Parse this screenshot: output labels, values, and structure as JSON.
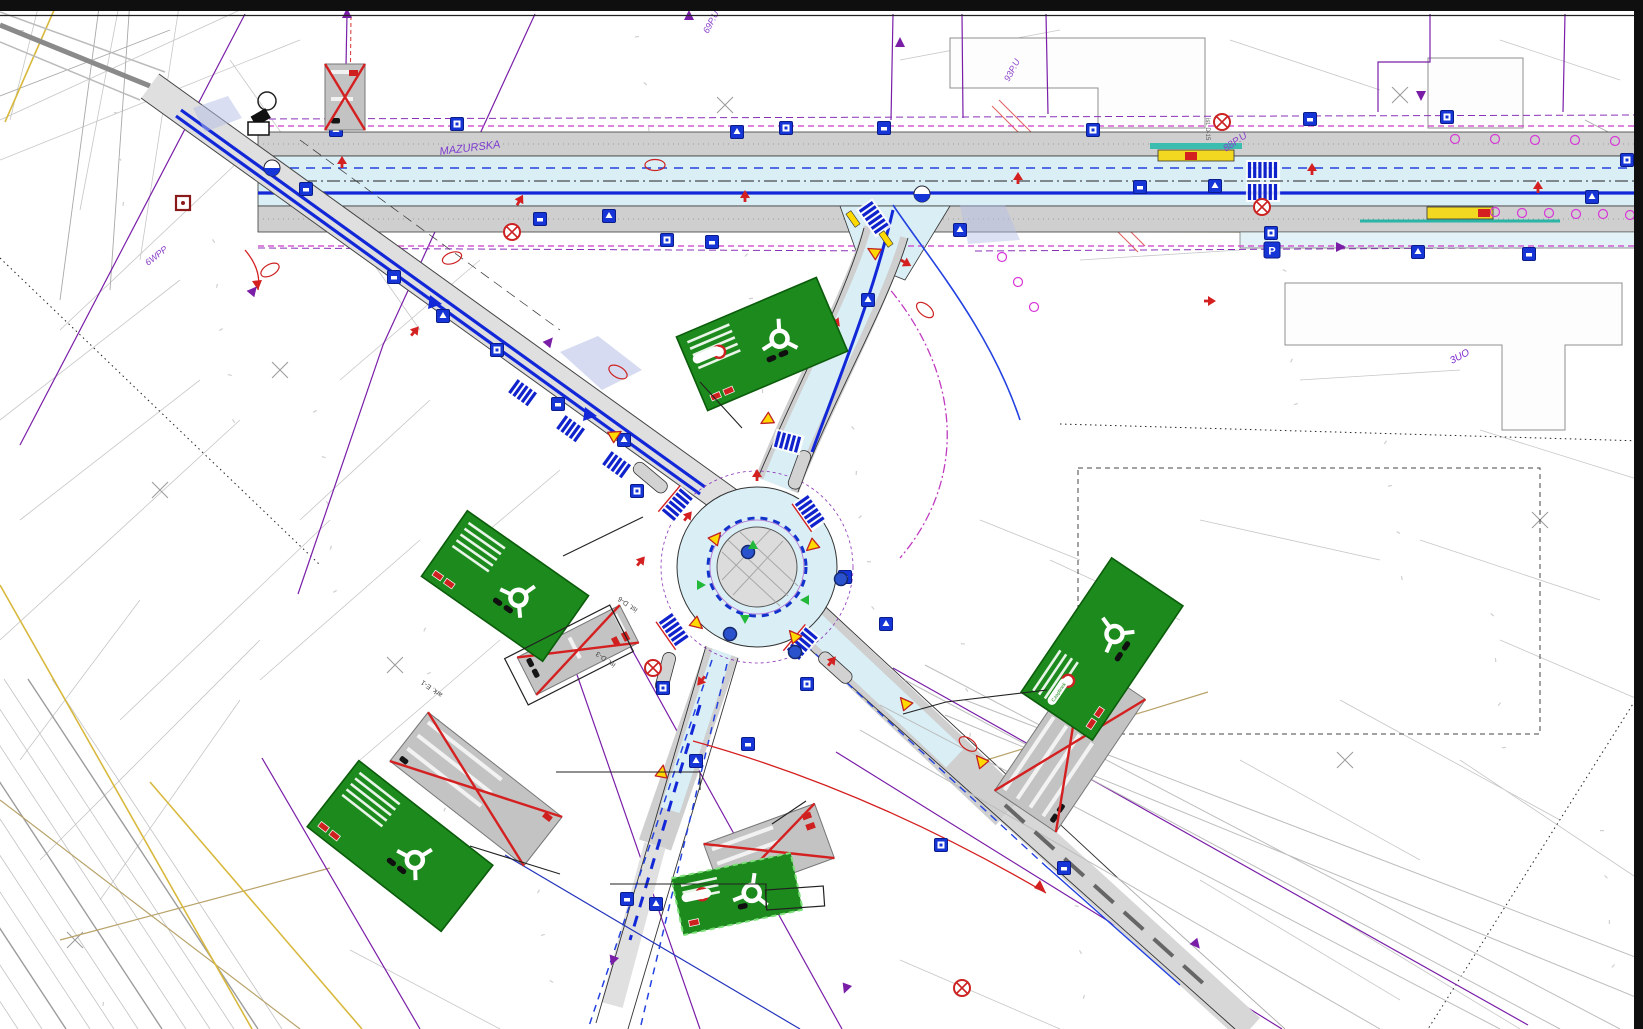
{
  "document": {
    "type": "traffic-organization-engineering-plan",
    "description": "Road design plan of a roundabout intersection with signage overlaid on cadastral map"
  },
  "palette": {
    "carriageway_cyan": "#d9eef5",
    "sidewalk_gray": "#cfcfcf",
    "marking_blue": "#1228d8",
    "secondary_blue": "#2342e0",
    "sign_blue": "#1535d6",
    "boundary_purple": "#7a1ea8",
    "magenta_dash": "#cb3bcb",
    "sign_green": "#1d8a1d",
    "sign_green_border": "#0b5c0b",
    "warning_yellow": "#ffd900",
    "bus_bar_yellow": "#f2d820",
    "teal_line": "#2ab5a5",
    "alert_red": "#d42020",
    "cadastral_gray": "#c6c6c6",
    "tan_line": "#b8a36a",
    "sheet_edge_black": "#0f0f0f"
  },
  "labels": [
    {
      "text": "MAZURSKA",
      "x": 440,
      "y": 155,
      "rot": -7,
      "size": 11,
      "color": "#7d3bd0",
      "italic": true
    },
    {
      "text": "88P.U",
      "x": 1226,
      "y": 152,
      "rot": -35,
      "size": 10,
      "color": "#8a40c8",
      "italic": true
    },
    {
      "text": "69P.U",
      "x": 708,
      "y": 34,
      "rot": -62,
      "size": 9,
      "color": "#8a40c8",
      "italic": true
    },
    {
      "text": "93P.U",
      "x": 1009,
      "y": 82,
      "rot": -62,
      "size": 9,
      "color": "#8a40c8",
      "italic": true
    },
    {
      "text": "6WPP",
      "x": 148,
      "y": 266,
      "rot": -38,
      "size": 9,
      "color": "#8a40c8",
      "italic": true
    },
    {
      "text": "3UO",
      "x": 1452,
      "y": 364,
      "rot": -28,
      "size": 10,
      "color": "#7d26cd",
      "italic": true
    },
    {
      "text": "ist. D-3",
      "x": 616,
      "y": 664,
      "rot": 215,
      "size": 7,
      "color": "#444",
      "italic": false
    },
    {
      "text": "ist. D-6",
      "x": 638,
      "y": 609,
      "rot": 215,
      "size": 7,
      "color": "#444",
      "italic": false
    },
    {
      "text": "ark. E-1",
      "x": 443,
      "y": 694,
      "rot": 215,
      "size": 7,
      "color": "#444",
      "italic": false
    },
    {
      "text": "ist. D-15",
      "x": 1206,
      "y": 118,
      "rot": 90,
      "size": 6,
      "color": "#555",
      "italic": false
    }
  ],
  "signs": {
    "route_pill_text": "Czaplinek",
    "green_direction_signs": [
      {
        "x": 762,
        "y": 344,
        "w": 152,
        "h": 80,
        "rot": -23,
        "dashed": false,
        "ring": true,
        "pill": true,
        "pill_text": "",
        "bars": 5,
        "badges": 2,
        "blobs": 2
      },
      {
        "x": 505,
        "y": 586,
        "w": 148,
        "h": 80,
        "rot": 35,
        "dashed": false,
        "ring": false,
        "pill": false,
        "pill_text": "",
        "bars": 5,
        "badges": 2,
        "blobs": 2
      },
      {
        "x": 400,
        "y": 846,
        "w": 170,
        "h": 84,
        "rot": 38,
        "dashed": false,
        "ring": false,
        "pill": false,
        "pill_text": "",
        "bars": 5,
        "badges": 2,
        "blobs": 2
      },
      {
        "x": 1102,
        "y": 649,
        "w": 162,
        "h": 86,
        "rot": -56,
        "dashed": false,
        "ring": true,
        "pill": true,
        "pill_text": "Czaplinek",
        "bars": 4,
        "badges": 2,
        "blobs": 2
      },
      {
        "x": 737,
        "y": 894,
        "w": 122,
        "h": 58,
        "rot": -12,
        "dashed": true,
        "ring": true,
        "pill": true,
        "pill_text": "",
        "bars": 3,
        "badges": 1,
        "blobs": 1
      }
    ],
    "removed_signs_gray": [
      {
        "x": 345,
        "y": 97,
        "w": 40,
        "h": 66,
        "rot": 0,
        "bars": 2,
        "badges": 1,
        "blobs": 1
      },
      {
        "x": 578,
        "y": 650,
        "w": 42,
        "h": 115,
        "rot": 63,
        "bars": 2,
        "badges": 2,
        "blobs": 2
      },
      {
        "x": 769,
        "y": 851,
        "w": 118,
        "h": 58,
        "rot": -20,
        "bars": 3,
        "badges": 2,
        "blobs": 1
      },
      {
        "x": 1070,
        "y": 745,
        "w": 160,
        "h": 74,
        "rot": -56,
        "bars": 4,
        "badges": 3,
        "blobs": 2
      },
      {
        "x": 476,
        "y": 789,
        "w": 170,
        "h": 62,
        "rot": 38,
        "bars": 3,
        "badges": 1,
        "blobs": 1
      }
    ]
  },
  "roundabout": {
    "cx": 757,
    "cy": 567,
    "outer_r": 80,
    "dashed_r": 49,
    "island_r": 40,
    "purple_r": 96
  },
  "crosswalks": [
    {
      "x": 677,
      "y": 505,
      "rot": 130,
      "n": 6,
      "red": true
    },
    {
      "x": 810,
      "y": 512,
      "rot": 55,
      "n": 6,
      "red": true
    },
    {
      "x": 674,
      "y": 630,
      "rot": 55,
      "n": 6,
      "red": true
    },
    {
      "x": 802,
      "y": 644,
      "rot": 130,
      "n": 6,
      "red": true
    },
    {
      "x": 874,
      "y": 218,
      "rot": 55,
      "n": 6,
      "red": false
    },
    {
      "x": 1263,
      "y": 170,
      "rot": 0,
      "n": 6,
      "red": false
    },
    {
      "x": 1263,
      "y": 192,
      "rot": 0,
      "n": 6,
      "red": false
    },
    {
      "x": 523,
      "y": 393,
      "rot": 36,
      "n": 5,
      "red": false
    },
    {
      "x": 571,
      "y": 429,
      "rot": 36,
      "n": 5,
      "red": false
    },
    {
      "x": 617,
      "y": 465,
      "rot": 36,
      "n": 5,
      "red": false
    },
    {
      "x": 788,
      "y": 442,
      "rot": 15,
      "n": 5,
      "red": false
    }
  ],
  "icons": {
    "blue_squares": [
      [
        306,
        189
      ],
      [
        336,
        130
      ],
      [
        457,
        124
      ],
      [
        540,
        219
      ],
      [
        609,
        216
      ],
      [
        667,
        240
      ],
      [
        712,
        242
      ],
      [
        737,
        132
      ],
      [
        786,
        128
      ],
      [
        884,
        128
      ],
      [
        960,
        230
      ],
      [
        1093,
        130
      ],
      [
        1140,
        187
      ],
      [
        1215,
        186
      ],
      [
        1271,
        233
      ],
      [
        1310,
        119
      ],
      [
        1418,
        252
      ],
      [
        1447,
        117
      ],
      [
        1529,
        254
      ],
      [
        1592,
        197
      ],
      [
        1627,
        160
      ],
      [
        394,
        277
      ],
      [
        443,
        316
      ],
      [
        497,
        350
      ],
      [
        558,
        404
      ],
      [
        624,
        440
      ],
      [
        637,
        491
      ],
      [
        845,
        577
      ],
      [
        886,
        624
      ],
      [
        663,
        688
      ],
      [
        748,
        744
      ],
      [
        696,
        761
      ],
      [
        807,
        684
      ],
      [
        627,
        899
      ],
      [
        656,
        904
      ],
      [
        941,
        845
      ],
      [
        1064,
        868
      ],
      [
        868,
        300
      ]
    ],
    "parking_sign": [
      1272,
      250
    ],
    "yellow_triangles": [
      [
        716,
        538,
        40
      ],
      [
        812,
        546,
        -130
      ],
      [
        697,
        624,
        130
      ],
      [
        794,
        636,
        -40
      ],
      [
        874,
        252,
        -60
      ],
      [
        905,
        703,
        -40
      ],
      [
        615,
        435,
        60
      ],
      [
        767,
        420,
        -120
      ],
      [
        662,
        772,
        10
      ],
      [
        981,
        761,
        -40
      ]
    ],
    "purple_triangles": [
      [
        689,
        16,
        0
      ],
      [
        900,
        43,
        0
      ],
      [
        1340,
        247,
        90
      ],
      [
        1421,
        95,
        180
      ],
      [
        347,
        14,
        0
      ],
      [
        253,
        291,
        40
      ],
      [
        549,
        342,
        40
      ],
      [
        846,
        988,
        200
      ],
      [
        613,
        960,
        200
      ],
      [
        1196,
        944,
        140
      ]
    ],
    "magenta_circles": [
      [
        1495,
        212
      ],
      [
        1522,
        213
      ],
      [
        1549,
        213
      ],
      [
        1576,
        214
      ],
      [
        1603,
        214
      ],
      [
        1630,
        215
      ],
      [
        1455,
        139
      ],
      [
        1495,
        139
      ],
      [
        1535,
        140
      ],
      [
        1575,
        140
      ],
      [
        1615,
        141
      ],
      [
        1002,
        257
      ],
      [
        1018,
        282
      ],
      [
        1034,
        307
      ]
    ],
    "red_markers": [
      [
        342,
        162,
        0
      ],
      [
        520,
        200,
        30
      ],
      [
        745,
        196,
        0
      ],
      [
        1018,
        178,
        0
      ],
      [
        1312,
        169,
        0
      ],
      [
        1538,
        187,
        0
      ],
      [
        906,
        263,
        120
      ],
      [
        836,
        322,
        140
      ],
      [
        688,
        516,
        40
      ],
      [
        641,
        561,
        40
      ],
      [
        701,
        681,
        220
      ],
      [
        832,
        661,
        40
      ],
      [
        560,
        641,
        220
      ],
      [
        415,
        331,
        40
      ],
      [
        1210,
        301,
        90
      ],
      [
        757,
        475,
        0
      ]
    ],
    "red_ellipses": [
      [
        452,
        258,
        -20
      ],
      [
        618,
        372,
        30
      ],
      [
        925,
        310,
        40
      ],
      [
        968,
        744,
        35
      ],
      [
        270,
        270,
        -30
      ],
      [
        655,
        165,
        0
      ]
    ],
    "red_ring_x": [
      [
        345,
        95
      ],
      [
        512,
        232
      ],
      [
        1262,
        207
      ],
      [
        962,
        988
      ],
      [
        653,
        668
      ],
      [
        1222,
        122
      ]
    ],
    "blue_dots": [
      [
        748,
        552
      ],
      [
        841,
        579
      ],
      [
        730,
        634
      ],
      [
        795,
        652
      ]
    ],
    "green_arrows": [
      [
        753,
        546,
        0
      ],
      [
        745,
        618,
        180
      ],
      [
        700,
        585,
        90
      ],
      [
        806,
        600,
        -90
      ]
    ],
    "blue_balls": [
      [
        272,
        168
      ],
      [
        922,
        194
      ]
    ]
  }
}
